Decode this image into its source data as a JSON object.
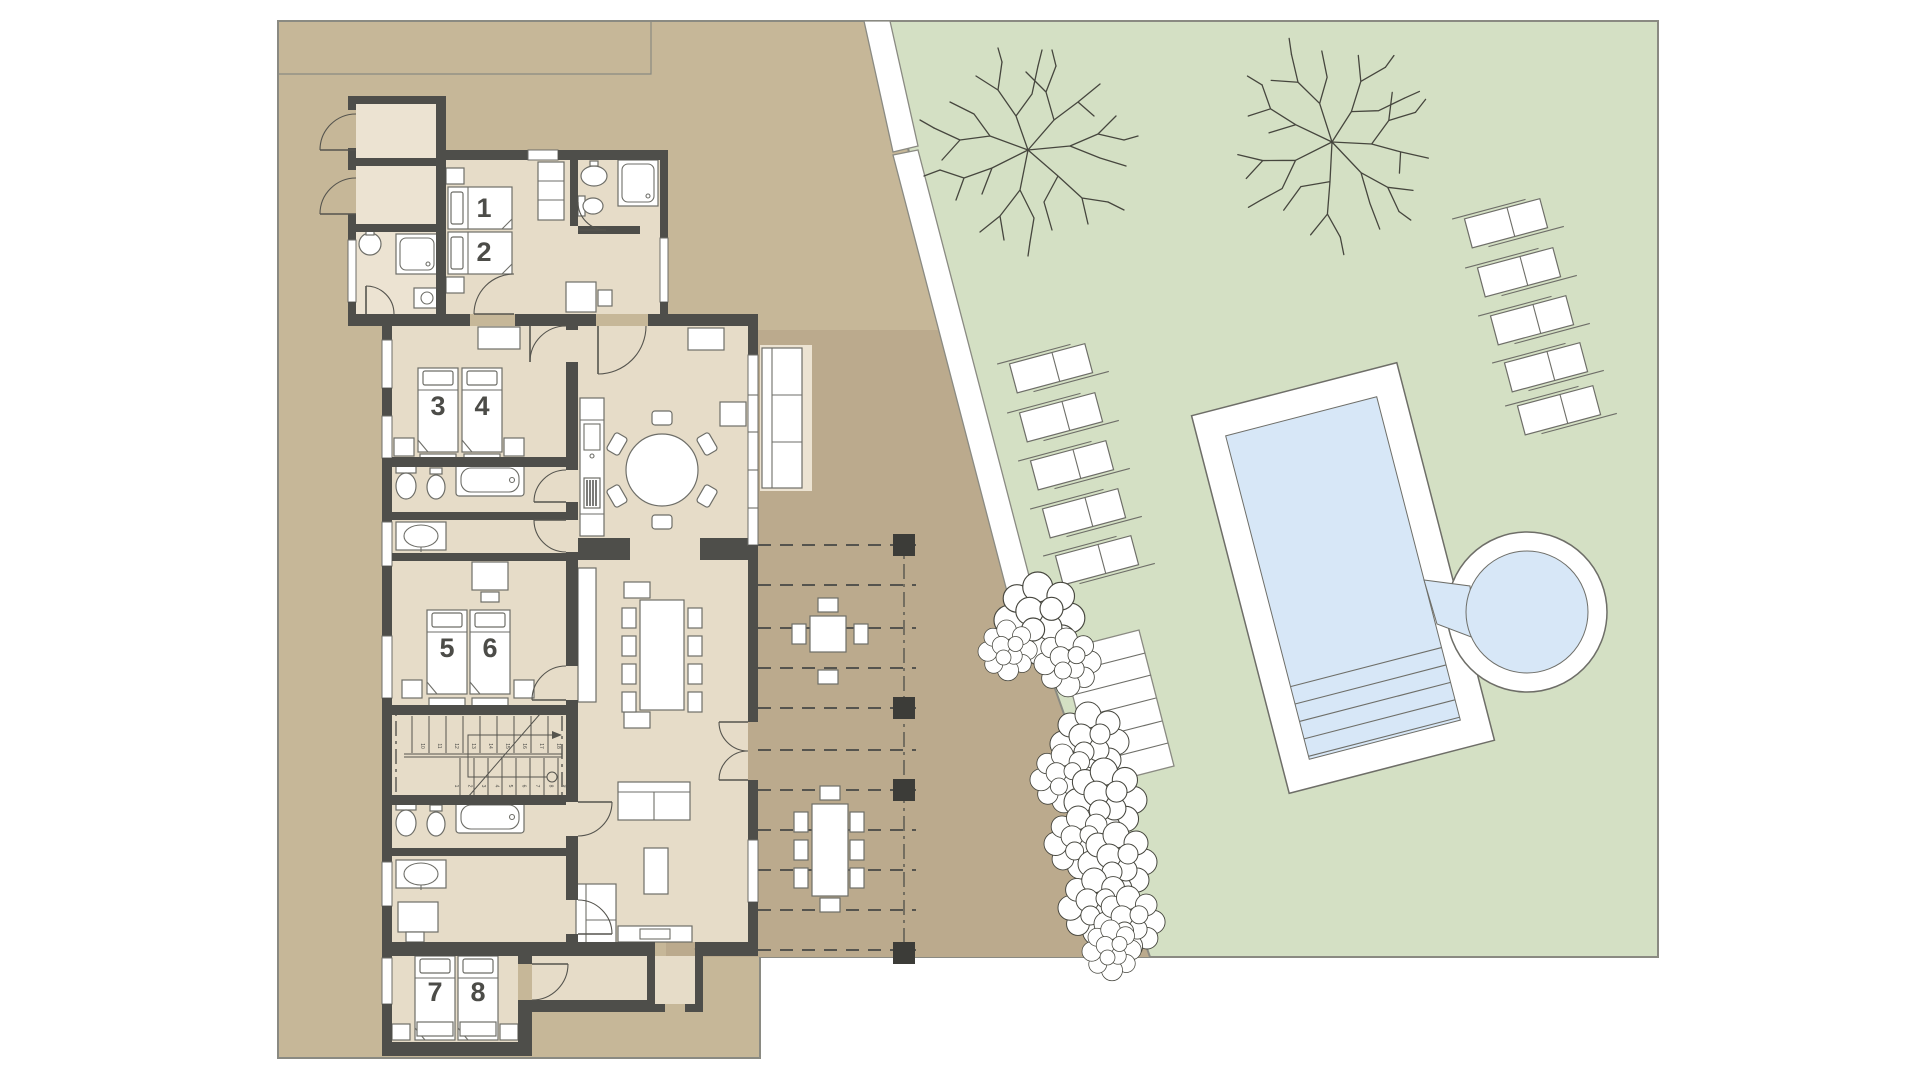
{
  "beds": [
    {
      "label": "1"
    },
    {
      "label": "2"
    },
    {
      "label": "3"
    },
    {
      "label": "4"
    },
    {
      "label": "5"
    },
    {
      "label": "6"
    },
    {
      "label": "7"
    },
    {
      "label": "8"
    }
  ],
  "stairs": {
    "lower_run_numbers": [
      "1",
      "2",
      "3",
      "4",
      "5",
      "6",
      "7",
      "8",
      "9"
    ],
    "upper_run_numbers": [
      "10",
      "11",
      "12",
      "13",
      "14",
      "15",
      "16",
      "17",
      "18"
    ]
  },
  "colors": {
    "site_tan": "#c6b798",
    "terrace_tan": "#bbaa8d",
    "garden_green": "#d4e0c4",
    "pool_water": "#d7e7f7",
    "interior_cream": "#e6dcc8",
    "porch_cream": "#ece3d2",
    "wall_dark": "#4e4e4a",
    "outline_gray": "#8a8a82",
    "furniture_stroke": "#6e6e68",
    "door_stroke": "#55544e",
    "post_dark": "#3c3c38",
    "branch_ink": "#46463e",
    "number_label": "#4c4c48"
  },
  "counts": {
    "numbered_beds": 8,
    "sun_loungers_left": 5,
    "sun_loungers_right": 5,
    "garden_trees": 2,
    "terrace_tables": 2,
    "pergola_posts": 4
  }
}
